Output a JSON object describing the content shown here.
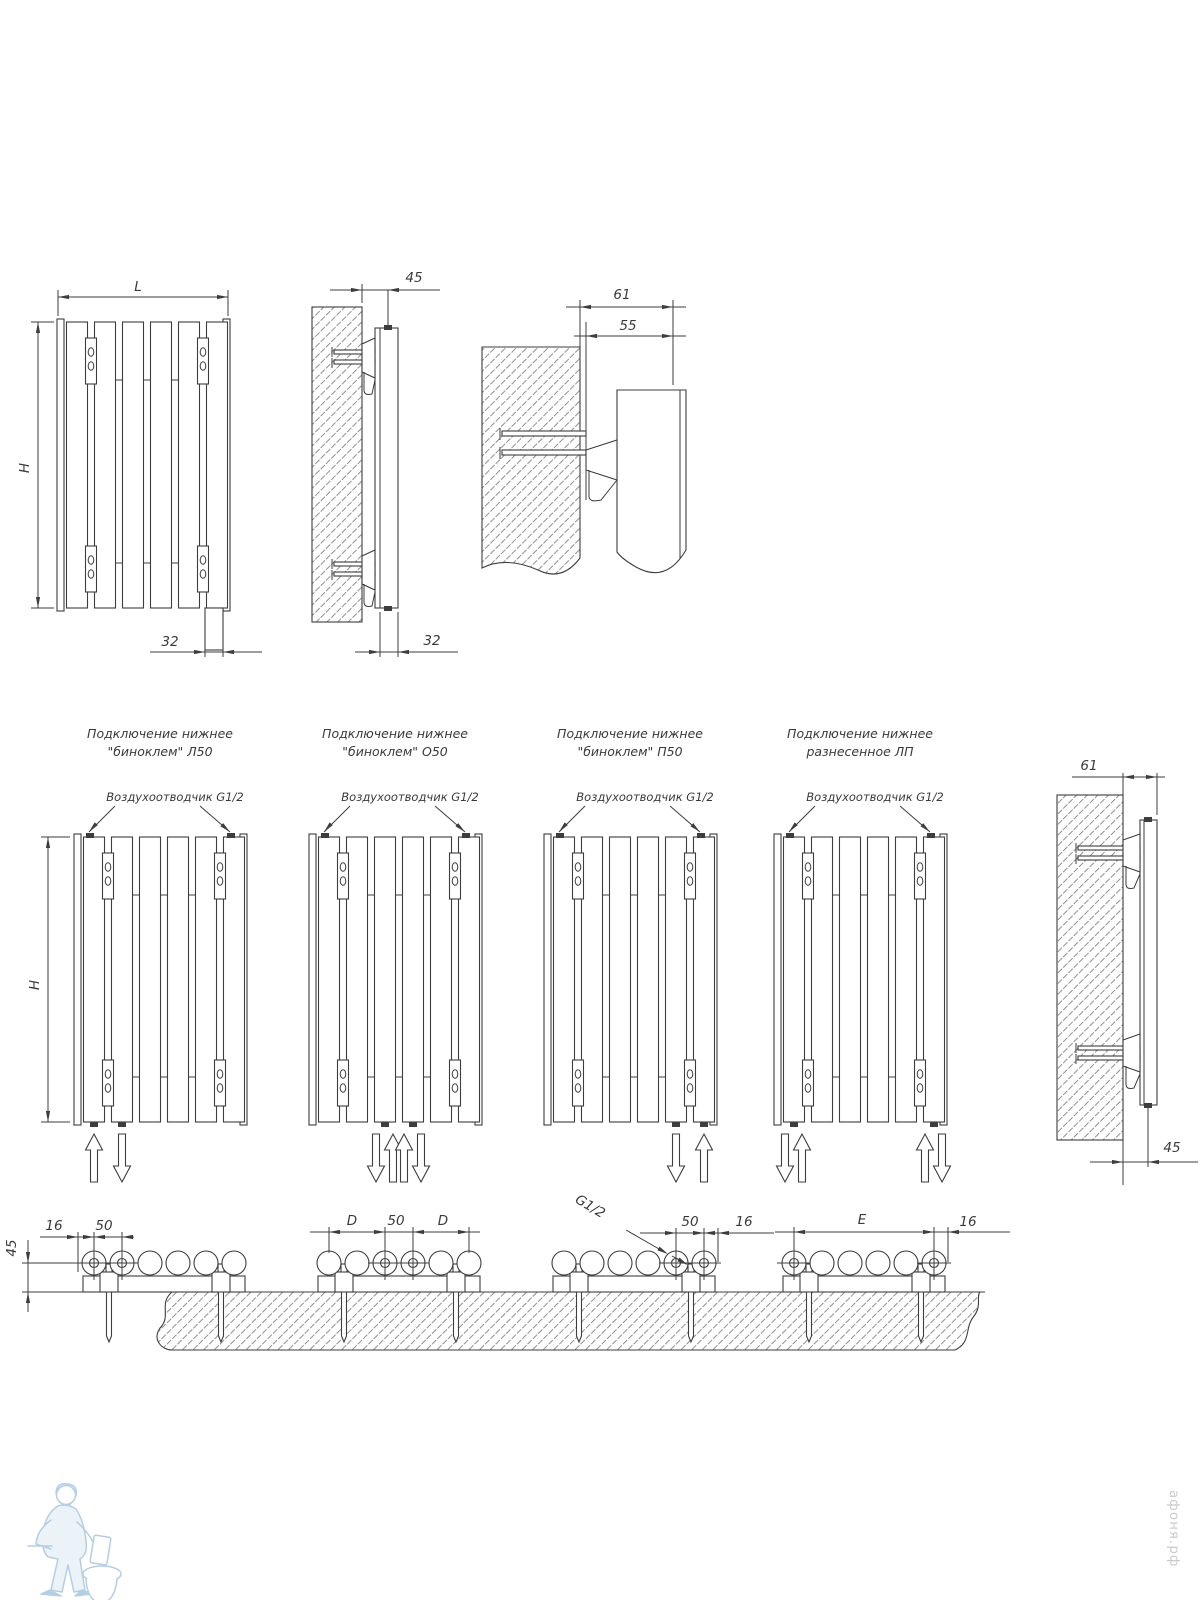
{
  "labels": {
    "front": {
      "L": "L",
      "H": "H",
      "d32": "32"
    },
    "side": {
      "d45": "45",
      "d32": "32"
    },
    "detail": {
      "d61": "61",
      "d55": "55"
    },
    "right": {
      "d61": "61",
      "d45": "45"
    },
    "secH": "H",
    "plan": {
      "d45": "45",
      "s1_16": "16",
      "s1_50": "50",
      "s2_D1": "D",
      "s2_50": "50",
      "s2_D2": "D",
      "s3_g": "G1/2",
      "s3_50": "50",
      "s3_16": "16",
      "s4_E": "E",
      "s4_16": "16"
    }
  },
  "sections": [
    {
      "title1": "Подключение нижнее",
      "title2": "\"биноклем\" Л50",
      "vent": "Воздухоотводчик G1/2",
      "connect_slots": [
        0,
        1
      ],
      "flow": [
        "up",
        "down"
      ]
    },
    {
      "title1": "Подключение нижнее",
      "title2": "\"биноклем\" О50",
      "vent": "Воздухоотводчик G1/2",
      "connect_slots": [
        2,
        3
      ],
      "flow": [
        "down",
        "up",
        "up",
        "down"
      ]
    },
    {
      "title1": "Подключение нижнее",
      "title2": "\"биноклем\" П50",
      "vent": "Воздухоотводчик G1/2",
      "connect_slots": [
        4,
        5
      ],
      "flow": [
        "down",
        "up"
      ]
    },
    {
      "title1": "Подключение нижнее",
      "title2": "разнесенное ЛП",
      "vent": "Воздухоотводчик G1/2",
      "connect_slots": [
        0,
        5
      ],
      "flow": [
        "down",
        "up",
        "up",
        "down"
      ]
    }
  ],
  "watermark": {
    "site": "афоня.рф"
  },
  "colors": {
    "line": "#3d3d3d",
    "watermark_blue": "#aec9e2",
    "watermark_text": "#cbcbcb"
  }
}
